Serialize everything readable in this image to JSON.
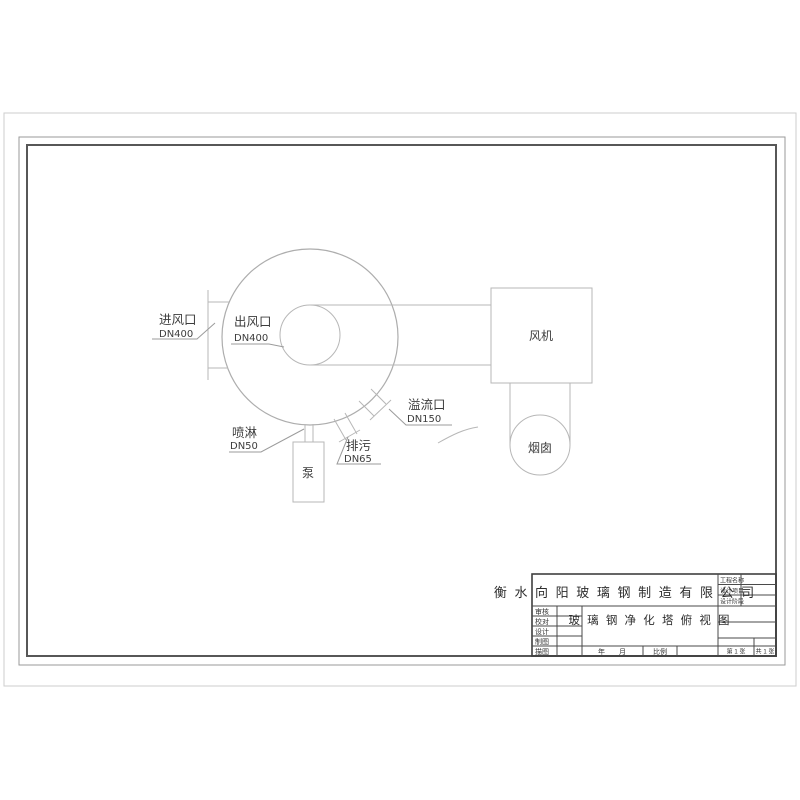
{
  "drawing": {
    "type": "engineering-plan-view",
    "sheet_orientation": "landscape"
  },
  "annotations": {
    "inlet": {
      "name": "进风口",
      "size": "DN400"
    },
    "outlet": {
      "name": "出风口",
      "size": "DN400"
    },
    "spray": {
      "name": "喷淋",
      "size": "DN50"
    },
    "drain": {
      "name": "排污",
      "size": "DN65"
    },
    "overflow": {
      "name": "溢流口",
      "size": "DN150"
    }
  },
  "equipment": {
    "pump": "泵",
    "fan": "风机",
    "chimney": "烟囱"
  },
  "title_block": {
    "company": "衡 水 向 阳 玻 璃 钢 制 造 有 限 公 司",
    "drawing_title": "玻 璃 钢 净 化 塔 俯 视 图",
    "right_labels": [
      "工程名称",
      "设计项目",
      "设计阶段"
    ],
    "left_labels": [
      "审核",
      "校对",
      "设计",
      "制图",
      "描图"
    ],
    "bottom": {
      "date_label": "年　　月",
      "scale_label": "比例",
      "sheet_label": "第 1 张",
      "total_label": "共 1 张"
    }
  },
  "colors": {
    "drawing_line": "#b7b7b7",
    "leader_line": "#9b9b9b",
    "text": "#3d3d3d",
    "frame_outer": "#9a9a9a",
    "frame_inner": "#575757",
    "title_block_line": "#4a4a4a",
    "paper_edge": "#cdcdcd",
    "background": "#ffffff"
  }
}
